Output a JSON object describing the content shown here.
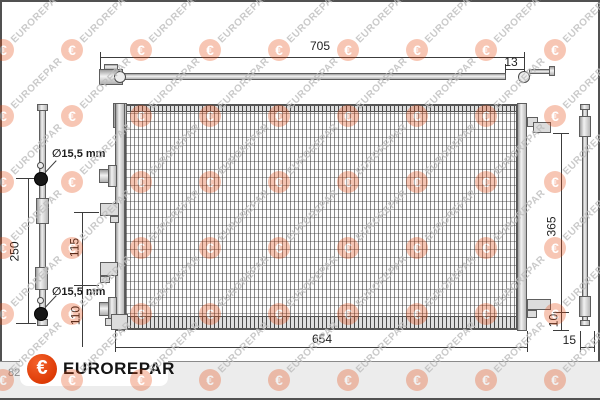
{
  "dims": {
    "top_width": "705",
    "top_offset": "13",
    "left_height": "250",
    "port_diameter_top": "∅15,5 mm",
    "port_diameter_bottom": "∅15,5 mm",
    "bracket_spacing": "115",
    "bracket_to_bottom": "110",
    "core_width": "654",
    "right_height": "365",
    "bottom_offset": "10",
    "side_depth": "15"
  },
  "footer": {
    "part_number_partial": "82",
    "brand": "EUROREPAR"
  },
  "watermark": {
    "text": "EUROREPAR",
    "logo_glyph": "€",
    "cols": 9,
    "rows": 6,
    "x_start": 3,
    "y_start": 50,
    "x_step": 69,
    "y_step": 66,
    "circle_color": "#e8470c",
    "text_color": "#bdbdbd"
  },
  "colors": {
    "accent_orange": "#e8470c",
    "line": "#3c3c3c",
    "footer_bg": "#ececec"
  }
}
